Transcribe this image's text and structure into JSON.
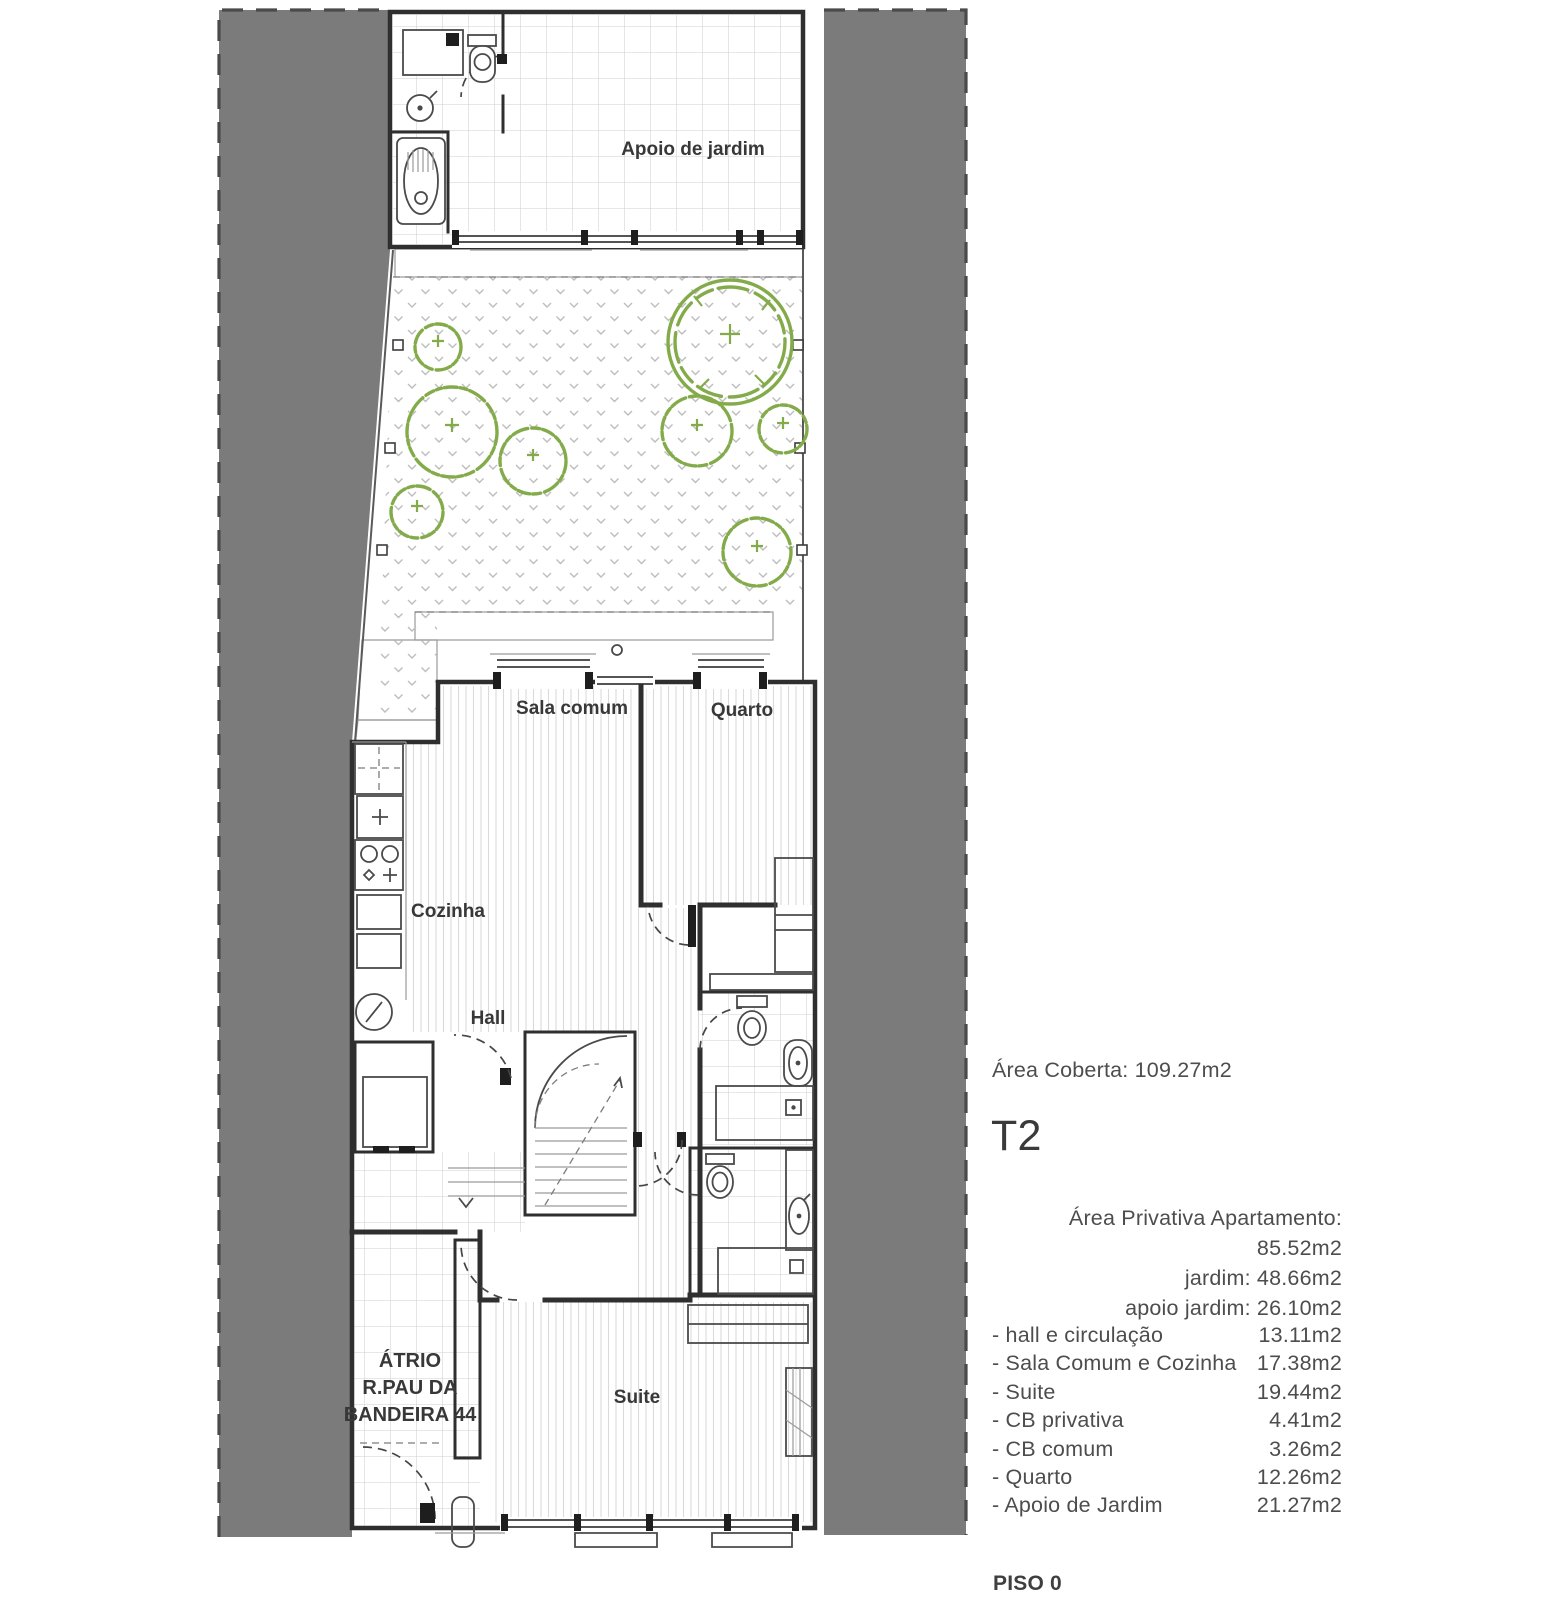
{
  "plan": {
    "rooms": {
      "apoio": "Apoio de jardim",
      "sala": "Sala comum",
      "quarto": "Quarto",
      "cozinha": "Cozinha",
      "hall": "Hall",
      "suite": "Suite",
      "atrio_line1": "ÁTRIO",
      "atrio_line2": "R.PAU DA",
      "atrio_line3": "BANDEIRA 44"
    },
    "colors": {
      "neighbor_gray": "#7b7b7b",
      "tree_green": "#84ab4a",
      "wall": "#2f2f2f"
    }
  },
  "panel": {
    "area_coberta": "Área Coberta: 109.27m2",
    "unit_type": "T2",
    "private_areas": [
      "Área Privativa Apartamento: 85.52m2",
      "jardim: 48.66m2",
      "apoio jardim:  26.10m2"
    ],
    "rooms": [
      {
        "label": "- hall e circulação",
        "value": "13.11m2"
      },
      {
        "label": "- Sala Comum e Cozinha",
        "value": "17.38m2"
      },
      {
        "label": "- Suite",
        "value": "19.44m2"
      },
      {
        "label": "- CB privativa",
        "value": "4.41m2"
      },
      {
        "label": "- CB comum",
        "value": "3.26m2"
      },
      {
        "label": "- Quarto",
        "value": "12.26m2"
      },
      {
        "label": "- Apoio de Jardim",
        "value": "21.27m2"
      }
    ],
    "floor_label": "PISO 0"
  }
}
